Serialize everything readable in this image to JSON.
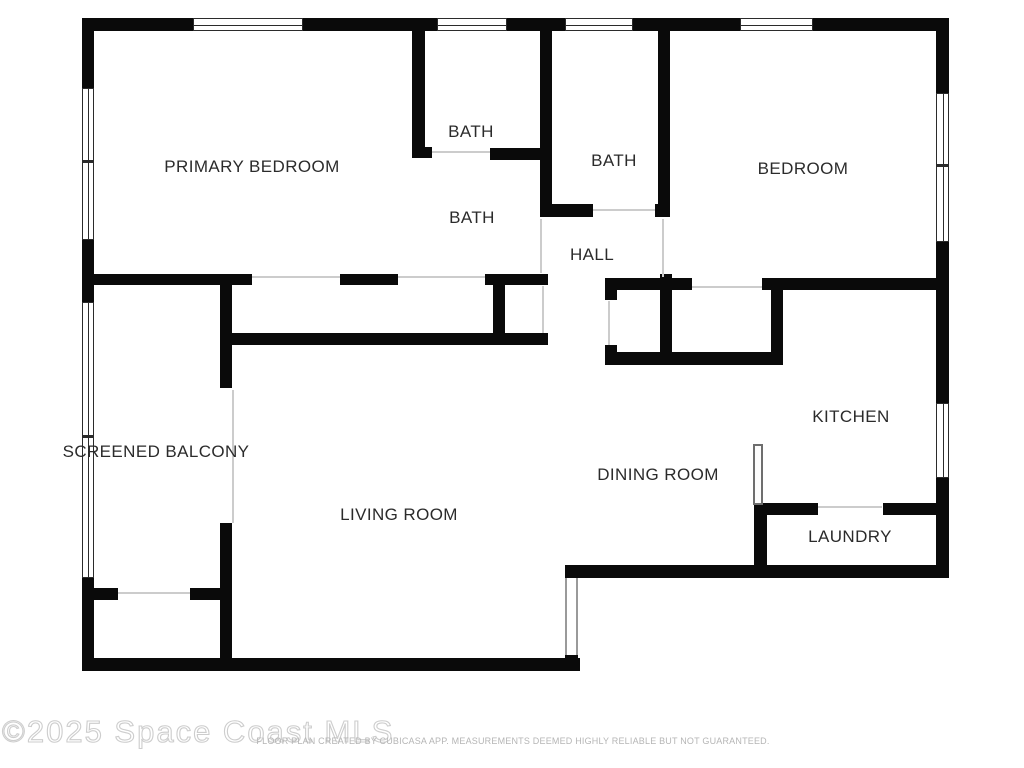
{
  "watermark": {
    "text": "©2025 Space Coast MLS"
  },
  "disclaimer": {
    "text": "FLOOR PLAN CREATED BY CUBICASA APP. MEASUREMENTS DEEMED HIGHLY RELIABLE BUT NOT GUARANTEED."
  },
  "colors": {
    "wall": "#0a0a0a",
    "door_line": "#cccccc",
    "label": "#2b2b2b",
    "watermark": "#cdcdcd",
    "disclaimer": "#b5b5b5",
    "background": "#ffffff"
  },
  "plan": {
    "labels": [
      {
        "name": "room-label-primary-bedroom",
        "text": "PRIMARY BEDROOM",
        "x": 252,
        "y": 167
      },
      {
        "name": "room-label-bath-top",
        "text": "BATH",
        "x": 471,
        "y": 132
      },
      {
        "name": "room-label-bath-middle",
        "text": "BATH",
        "x": 614,
        "y": 161
      },
      {
        "name": "room-label-bath-primary",
        "text": "BATH",
        "x": 472,
        "y": 218
      },
      {
        "name": "room-label-hall",
        "text": "HALL",
        "x": 592,
        "y": 255
      },
      {
        "name": "room-label-bedroom",
        "text": "BEDROOM",
        "x": 803,
        "y": 169
      },
      {
        "name": "room-label-screened-balcony",
        "text": "SCREENED BALCONY",
        "x": 156,
        "y": 452
      },
      {
        "name": "room-label-living-room",
        "text": "LIVING ROOM",
        "x": 399,
        "y": 515
      },
      {
        "name": "room-label-dining-room",
        "text": "DINING ROOM",
        "x": 658,
        "y": 475
      },
      {
        "name": "room-label-kitchen",
        "text": "KITCHEN",
        "x": 851,
        "y": 417
      },
      {
        "name": "room-label-laundry",
        "text": "LAUNDRY",
        "x": 850,
        "y": 537
      }
    ],
    "rects": [
      {
        "type": "wall",
        "name": "wall-top-1",
        "x": 82,
        "y": 18,
        "w": 111,
        "h": 13
      },
      {
        "type": "wall",
        "name": "wall-top-2",
        "x": 303,
        "y": 18,
        "w": 134,
        "h": 13
      },
      {
        "type": "wall",
        "name": "wall-top-3",
        "x": 507,
        "y": 18,
        "w": 58,
        "h": 13
      },
      {
        "type": "wall",
        "name": "wall-top-4",
        "x": 633,
        "y": 18,
        "w": 107,
        "h": 13
      },
      {
        "type": "wall",
        "name": "wall-top-5",
        "x": 813,
        "y": 18,
        "w": 135,
        "h": 13
      },
      {
        "type": "wall",
        "name": "wall-left-1",
        "x": 82,
        "y": 18,
        "w": 12,
        "h": 70
      },
      {
        "type": "wall",
        "name": "wall-left-2",
        "x": 82,
        "y": 240,
        "w": 12,
        "h": 62
      },
      {
        "type": "wall",
        "name": "wall-left-3",
        "x": 82,
        "y": 578,
        "w": 12,
        "h": 93
      },
      {
        "type": "wall",
        "name": "wall-right-1",
        "x": 936,
        "y": 18,
        "w": 13,
        "h": 75
      },
      {
        "type": "wall",
        "name": "wall-right-2",
        "x": 936,
        "y": 242,
        "w": 13,
        "h": 161
      },
      {
        "type": "wall",
        "name": "wall-right-3",
        "x": 936,
        "y": 478,
        "w": 13,
        "h": 100
      },
      {
        "type": "wall",
        "name": "wall-bottom-living",
        "x": 82,
        "y": 658,
        "w": 498,
        "h": 13
      },
      {
        "type": "wall",
        "name": "wall-bottom-dining-laundry",
        "x": 565,
        "y": 565,
        "w": 384,
        "h": 13
      },
      {
        "type": "wall",
        "name": "wall-step-cap",
        "x": 565,
        "y": 655,
        "w": 13,
        "h": 8
      },
      {
        "type": "wall",
        "name": "wall-bath-divider",
        "x": 412,
        "y": 31,
        "w": 13,
        "h": 127
      },
      {
        "type": "wall",
        "name": "wall-bath-divider-stub",
        "x": 412,
        "y": 147,
        "w": 20,
        "h": 11
      },
      {
        "type": "wall",
        "name": "wall-bath-top-bottom",
        "x": 490,
        "y": 148,
        "w": 50,
        "h": 12
      },
      {
        "type": "wall",
        "name": "wall-midbath-left",
        "x": 540,
        "y": 31,
        "w": 12,
        "h": 186
      },
      {
        "type": "wall",
        "name": "wall-midbath-stub-left",
        "x": 540,
        "y": 204,
        "w": 53,
        "h": 13
      },
      {
        "type": "wall",
        "name": "wall-midbath-stub-right",
        "x": 655,
        "y": 204,
        "w": 15,
        "h": 13
      },
      {
        "type": "wall",
        "name": "wall-midbath-right",
        "x": 658,
        "y": 31,
        "w": 12,
        "h": 186
      },
      {
        "type": "wall",
        "name": "wall-closet-top-1",
        "x": 94,
        "y": 274,
        "w": 158,
        "h": 11
      },
      {
        "type": "wall",
        "name": "wall-closet-top-2",
        "x": 340,
        "y": 274,
        "w": 58,
        "h": 11
      },
      {
        "type": "wall",
        "name": "wall-closet-top-3",
        "x": 485,
        "y": 274,
        "w": 63,
        "h": 11
      },
      {
        "type": "wall",
        "name": "wall-closet-bottom",
        "x": 220,
        "y": 333,
        "w": 328,
        "h": 12
      },
      {
        "type": "wall",
        "name": "wall-closet-divider",
        "x": 493,
        "y": 285,
        "w": 12,
        "h": 48
      },
      {
        "type": "wall",
        "name": "wall-balcony-upper",
        "x": 220,
        "y": 274,
        "w": 12,
        "h": 114
      },
      {
        "type": "wall",
        "name": "wall-balcony-lower",
        "x": 220,
        "y": 523,
        "w": 12,
        "h": 140
      },
      {
        "type": "wall",
        "name": "wall-storage-1",
        "x": 94,
        "y": 588,
        "w": 24,
        "h": 12
      },
      {
        "type": "wall",
        "name": "wall-storage-2",
        "x": 190,
        "y": 588,
        "w": 30,
        "h": 12
      },
      {
        "type": "wall",
        "name": "wall-bedroom-bottom-1",
        "x": 605,
        "y": 278,
        "w": 87,
        "h": 12
      },
      {
        "type": "wall",
        "name": "wall-bedroom-bottom-2",
        "x": 762,
        "y": 278,
        "w": 186,
        "h": 12
      },
      {
        "type": "wall",
        "name": "wall-hallcloset-stub",
        "x": 605,
        "y": 290,
        "w": 12,
        "h": 10
      },
      {
        "type": "wall",
        "name": "wall-hallcloset-lower",
        "x": 605,
        "y": 345,
        "w": 12,
        "h": 20
      },
      {
        "type": "wall",
        "name": "wall-closet-mid",
        "x": 660,
        "y": 274,
        "w": 12,
        "h": 91
      },
      {
        "type": "wall",
        "name": "wall-closet-right",
        "x": 771,
        "y": 283,
        "w": 12,
        "h": 82
      },
      {
        "type": "wall",
        "name": "wall-closet2-bottom",
        "x": 605,
        "y": 352,
        "w": 178,
        "h": 13
      },
      {
        "type": "wall",
        "name": "wall-laundry-left",
        "x": 754,
        "y": 503,
        "w": 13,
        "h": 75
      },
      {
        "type": "wall",
        "name": "wall-laundry-top-1",
        "x": 754,
        "y": 503,
        "w": 64,
        "h": 12
      },
      {
        "type": "wall",
        "name": "wall-laundry-top-2",
        "x": 883,
        "y": 503,
        "w": 53,
        "h": 12
      },
      {
        "type": "window-h",
        "name": "window-top-primary",
        "x": 193,
        "y": 18,
        "w": 110,
        "h": 13
      },
      {
        "type": "window-h",
        "name": "window-top-bath",
        "x": 437,
        "y": 18,
        "w": 70,
        "h": 13
      },
      {
        "type": "window-h",
        "name": "window-top-midbath",
        "x": 565,
        "y": 18,
        "w": 68,
        "h": 13
      },
      {
        "type": "window-h",
        "name": "window-top-bedroom",
        "x": 740,
        "y": 18,
        "w": 73,
        "h": 13
      },
      {
        "type": "window-v",
        "name": "window-left-primary",
        "x": 82,
        "y": 88,
        "w": 12,
        "h": 152
      },
      {
        "type": "window-v",
        "name": "window-left-balcony",
        "x": 82,
        "y": 302,
        "w": 12,
        "h": 276
      },
      {
        "type": "window-v",
        "name": "window-right-bedroom",
        "x": 936,
        "y": 93,
        "w": 13,
        "h": 149
      },
      {
        "type": "window-v",
        "name": "window-right-kitchen",
        "x": 936,
        "y": 403,
        "w": 13,
        "h": 75
      },
      {
        "type": "window-divider",
        "name": "window-divider-left-1",
        "x": 82,
        "y": 160,
        "w": 12,
        "h": 3
      },
      {
        "type": "window-divider",
        "name": "window-divider-left-2",
        "x": 82,
        "y": 435,
        "w": 12,
        "h": 3
      },
      {
        "type": "window-divider",
        "name": "window-divider-right-1",
        "x": 936,
        "y": 164,
        "w": 13,
        "h": 3
      },
      {
        "type": "slider",
        "name": "slider-living-southeast",
        "x": 565,
        "y": 578,
        "w": 13,
        "h": 77
      },
      {
        "type": "door-leaf",
        "name": "door-leaf-kitchen",
        "x": 753,
        "y": 444,
        "w": 10,
        "h": 61
      },
      {
        "type": "door-line",
        "name": "door-bath-top",
        "x": 432,
        "y": 151,
        "w": 58,
        "h": 2
      },
      {
        "type": "door-line",
        "name": "door-bath-middle",
        "x": 593,
        "y": 209,
        "w": 62,
        "h": 2
      },
      {
        "type": "door-line",
        "name": "door-closet-slider-1",
        "x": 252,
        "y": 276,
        "w": 88,
        "h": 2
      },
      {
        "type": "door-line",
        "name": "door-closet-slider-2",
        "x": 398,
        "y": 276,
        "w": 87,
        "h": 2
      },
      {
        "type": "door-line",
        "name": "door-hall-closet",
        "x": 542,
        "y": 286,
        "w": 2,
        "h": 47
      },
      {
        "type": "door-line",
        "name": "door-bath-hall",
        "x": 540,
        "y": 219,
        "w": 2,
        "h": 54
      },
      {
        "type": "door-line",
        "name": "door-bedroom",
        "x": 662,
        "y": 219,
        "w": 2,
        "h": 58
      },
      {
        "type": "door-line",
        "name": "door-bedroom-closet",
        "x": 692,
        "y": 286,
        "w": 70,
        "h": 2
      },
      {
        "type": "door-line",
        "name": "door-linen-closet",
        "x": 608,
        "y": 301,
        "w": 2,
        "h": 44
      },
      {
        "type": "door-line",
        "name": "door-storage",
        "x": 118,
        "y": 592,
        "w": 72,
        "h": 2
      },
      {
        "type": "door-line",
        "name": "door-balcony",
        "x": 232,
        "y": 390,
        "w": 2,
        "h": 133
      },
      {
        "type": "door-line",
        "name": "door-laundry",
        "x": 818,
        "y": 506,
        "w": 64,
        "h": 2
      }
    ]
  }
}
